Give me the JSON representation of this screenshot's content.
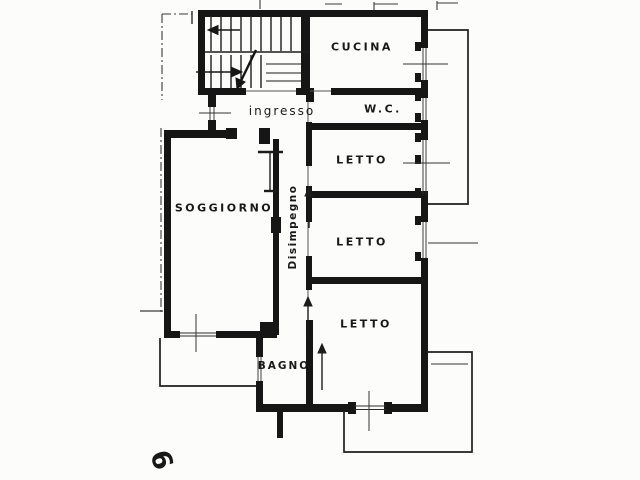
{
  "drawing": {
    "kind": "apartment floor plan (scanned blueprint)",
    "language": "Italian"
  },
  "rooms": {
    "cucina": {
      "label": "CUCINA"
    },
    "ingresso": {
      "label": "ingresso"
    },
    "wc": {
      "label": "W.C."
    },
    "letto1": {
      "label": "LETTO"
    },
    "letto2": {
      "label": "LETTO"
    },
    "letto3": {
      "label": "LETTO"
    },
    "soggiorno": {
      "label": "SOGGIORNO"
    },
    "disimpegno": {
      "label": "Disimpegno"
    },
    "bagno": {
      "label": "BAGNO"
    }
  },
  "annotations": {
    "sheet_mark": "6"
  },
  "icons": {
    "stair_direction_arrows": "left-arrow, right-arrow, diagonal-break-arrow",
    "door_swing_indicators": "up-arrow lines in corridor"
  },
  "colors": {
    "ink": "#161616",
    "thin_line": "#333333",
    "paper": "#fcfcfa"
  }
}
